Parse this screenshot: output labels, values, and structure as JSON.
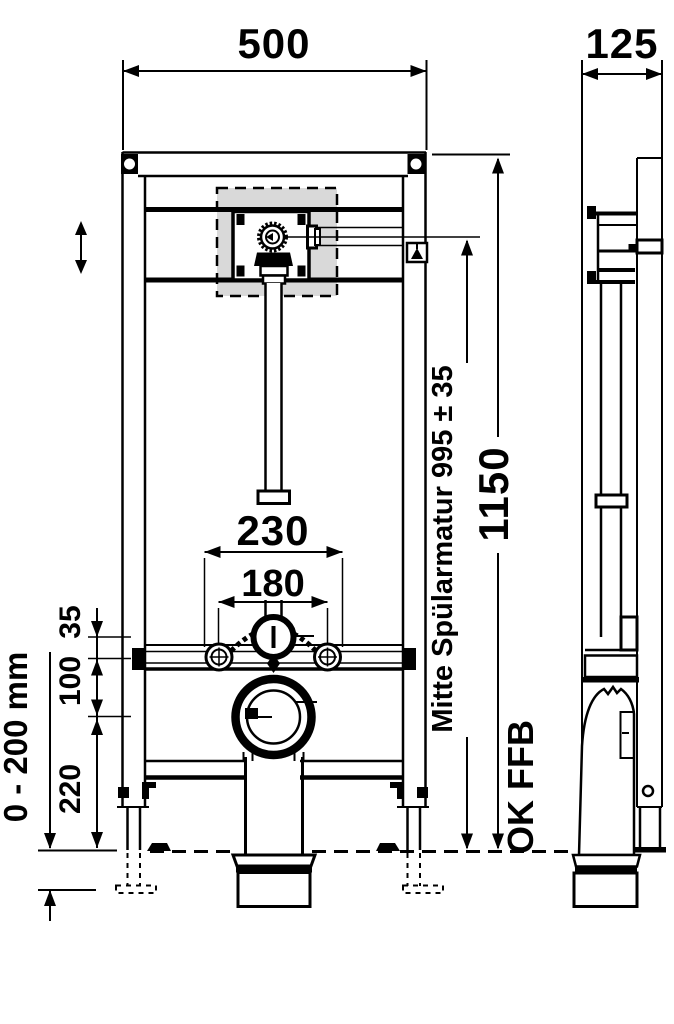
{
  "drawing": {
    "kind": "technical-drawing",
    "views": {
      "front": "front-view",
      "side": "side-view"
    }
  },
  "colors": {
    "line": "#000000",
    "background": "#ffffff",
    "inspection_box_fill": "#d9d9d9"
  },
  "icons": {
    "height_adjust": "double-vertical-arrow",
    "level_mark": "triangle-in-box"
  },
  "labels": {
    "front_width": "500",
    "side_depth": "125",
    "total_height": "1150",
    "flush_valve_center": "Mitte Spülarmatur 995 ± 35",
    "floor_reference": "OK FFB",
    "fixing_spacing_wide": "230",
    "fixing_spacing_narrow": "180",
    "offset_35": "35",
    "offset_100": "100",
    "outlet_height_220": "220",
    "foot_adjust_range": "0 - 200 mm"
  }
}
